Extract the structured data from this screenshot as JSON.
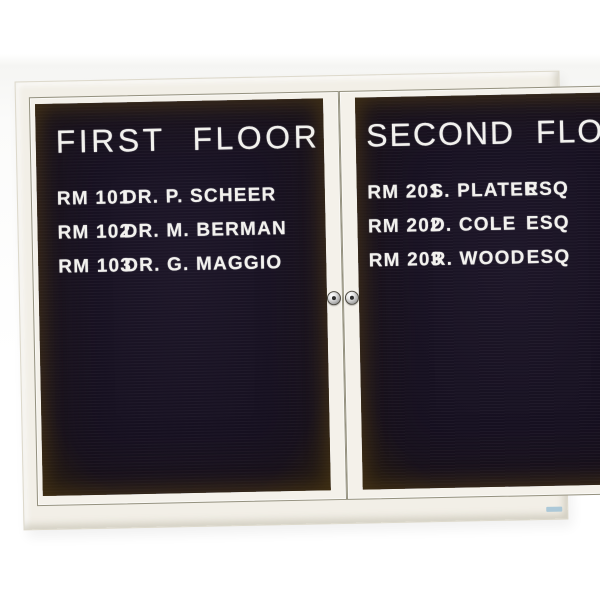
{
  "board": {
    "frame_color": "#f2efe7",
    "panel_color": "#171121",
    "letter_color": "#f2f1ee",
    "doors": [
      {
        "title": "FIRST FLOOR",
        "rows": [
          {
            "room": "RM 101",
            "name": "DR. P. SCHEER"
          },
          {
            "room": "RM 102",
            "name": "DR. M. BERMAN"
          },
          {
            "room": "RM 103",
            "name": "DR. G. MAGGIO"
          }
        ]
      },
      {
        "title": "SECOND FLOOR",
        "rows": [
          {
            "room": "RM 201",
            "name": "S. PLATER",
            "suffix": "ESQ"
          },
          {
            "room": "RM 202",
            "name": "D. COLE",
            "suffix": "ESQ"
          },
          {
            "room": "RM 203",
            "name": "R. WOOD",
            "suffix": "ESQ"
          }
        ]
      }
    ]
  }
}
